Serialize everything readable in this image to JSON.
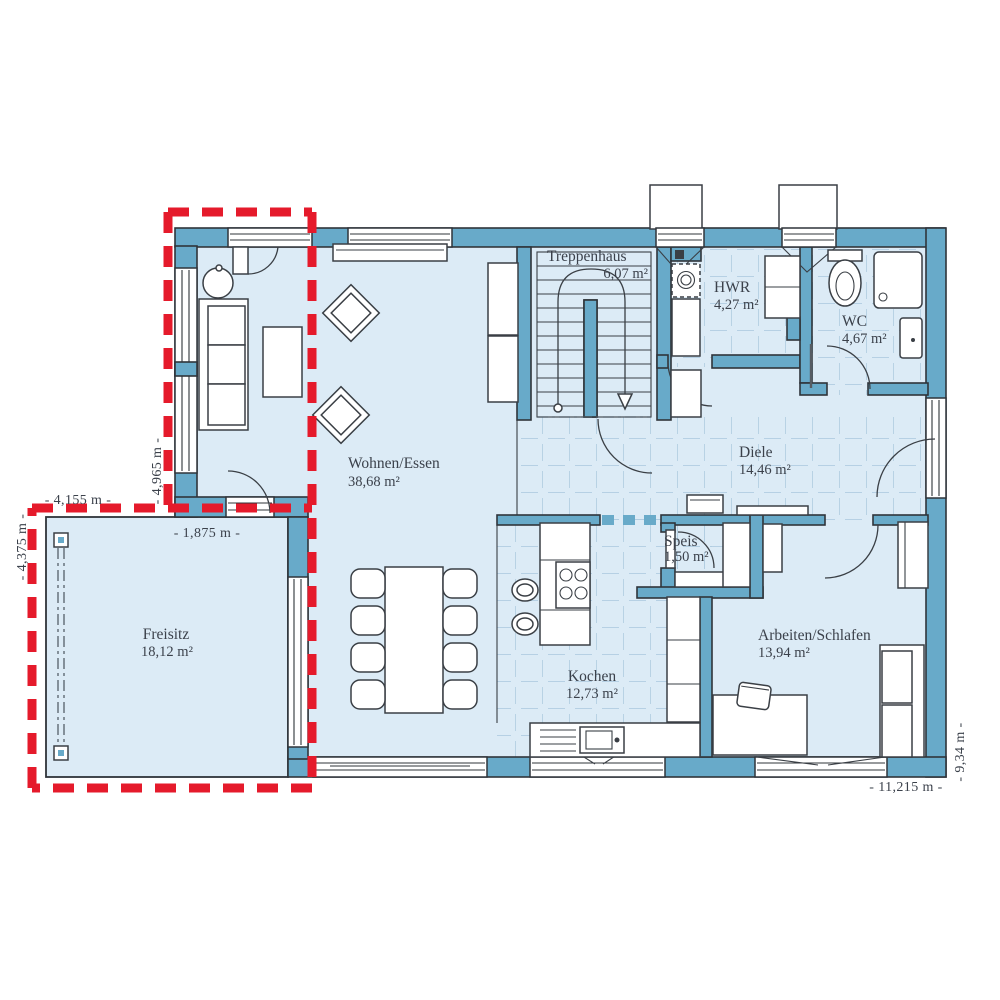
{
  "plan": {
    "type": "floor-plan",
    "rooms": [
      {
        "id": "wohnen-essen",
        "name": "Wohnen/Essen",
        "area": "38,68 m²"
      },
      {
        "id": "treppenhaus",
        "name": "Treppenhaus",
        "area": "6,07 m²"
      },
      {
        "id": "hwr",
        "name": "HWR",
        "area": "4,27 m²"
      },
      {
        "id": "wc",
        "name": "WC",
        "area": "4,67 m²"
      },
      {
        "id": "diele",
        "name": "Diele",
        "area": "14,46 m²"
      },
      {
        "id": "speis",
        "name": "Speis",
        "area": "1,50 m²"
      },
      {
        "id": "kochen",
        "name": "Kochen",
        "area": "12,73 m²"
      },
      {
        "id": "arbeiten-schlafen",
        "name": "Arbeiten/Schlafen",
        "area": "13,94 m²"
      },
      {
        "id": "freisitz",
        "name": "Freisitz",
        "area": "18,12 m²"
      }
    ],
    "dimensions": [
      {
        "id": "freisitz-width",
        "label": "- 4,155 m -"
      },
      {
        "id": "freisitz-height",
        "label": "- 4,375 m -"
      },
      {
        "id": "bay-height",
        "label": "- 4,965 m -"
      },
      {
        "id": "bay-width",
        "label": "- 1,875 m -"
      },
      {
        "id": "house-depth",
        "label": "- 9,34 m -"
      },
      {
        "id": "house-width",
        "label": "- 11,215 m -"
      }
    ]
  },
  "colors": {
    "wall": "#68aac9",
    "room": "#dcebf6",
    "tile": "#a9c8dd",
    "outline": "#2f343a",
    "red": "#e51a2b",
    "text": "#3b414b"
  }
}
